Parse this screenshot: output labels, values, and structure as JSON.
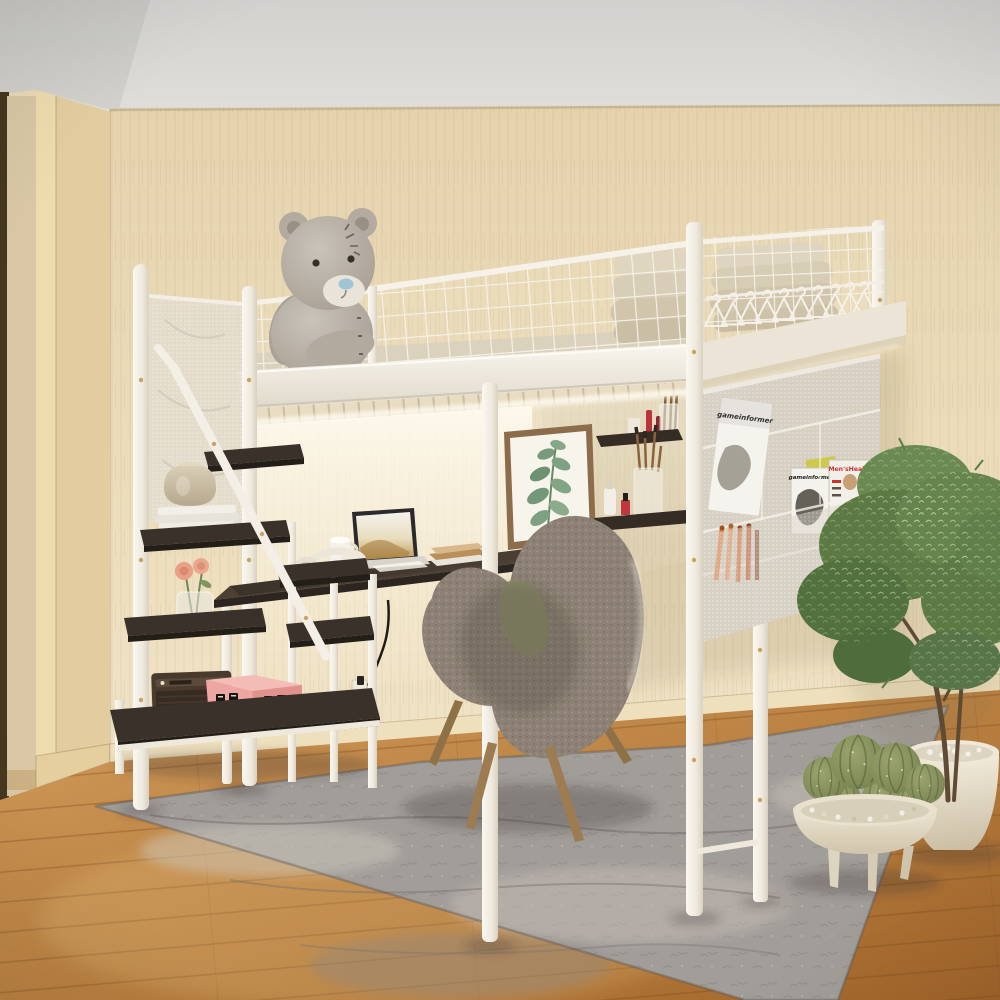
{
  "scene": {
    "setting": "bedroom corner with beige textured wallpaper, oak wood floor and gray vintage area rug",
    "subject": "white metal loft bed with under-bed desk, storage staircase, mesh guardrails and hanging pocket organizer",
    "palette": {
      "wall": "#ead9b6",
      "ceiling": "#d8d7d3",
      "floor_wood": "#b97b36",
      "rug": "#a09c98",
      "bed_frame_white": "#f3efe7",
      "shelf_wood_dark": "#3a312a",
      "mattress_pad": "#d6cbb2",
      "chair_boucle": "#8d8175",
      "box_pink": "#eda6a2",
      "plant_green": "#5d7a45",
      "magazine_red": "#c8332e",
      "led_light": "#fffdf4"
    },
    "objects": [
      "loft-bed",
      "wire-guardrail",
      "clothes-hangers",
      "folded-mattress",
      "teddy-bear",
      "storage-staircase",
      "step-shelves",
      "stair-handrail",
      "mesh-safety-net",
      "desk",
      "laptop",
      "headphones",
      "mug",
      "books",
      "power-outlet",
      "power-cable",
      "framed-botanical-print",
      "floating-shelves",
      "cosmetics",
      "mesh-pocket-organizer",
      "magazines",
      "marker-pens",
      "accent-chair",
      "area-rug",
      "potted-tree",
      "cactus-bowl-planter",
      "retro-speaker",
      "pink-gift-box",
      "rose-vase",
      "ceramic-vase",
      "doorway",
      "led-strip"
    ],
    "magazines": {
      "hanging": {
        "title": "gameinformer"
      },
      "standing": {
        "title": "gameinformer"
      },
      "mens_health": {
        "title": "Men'sHealth"
      }
    }
  }
}
